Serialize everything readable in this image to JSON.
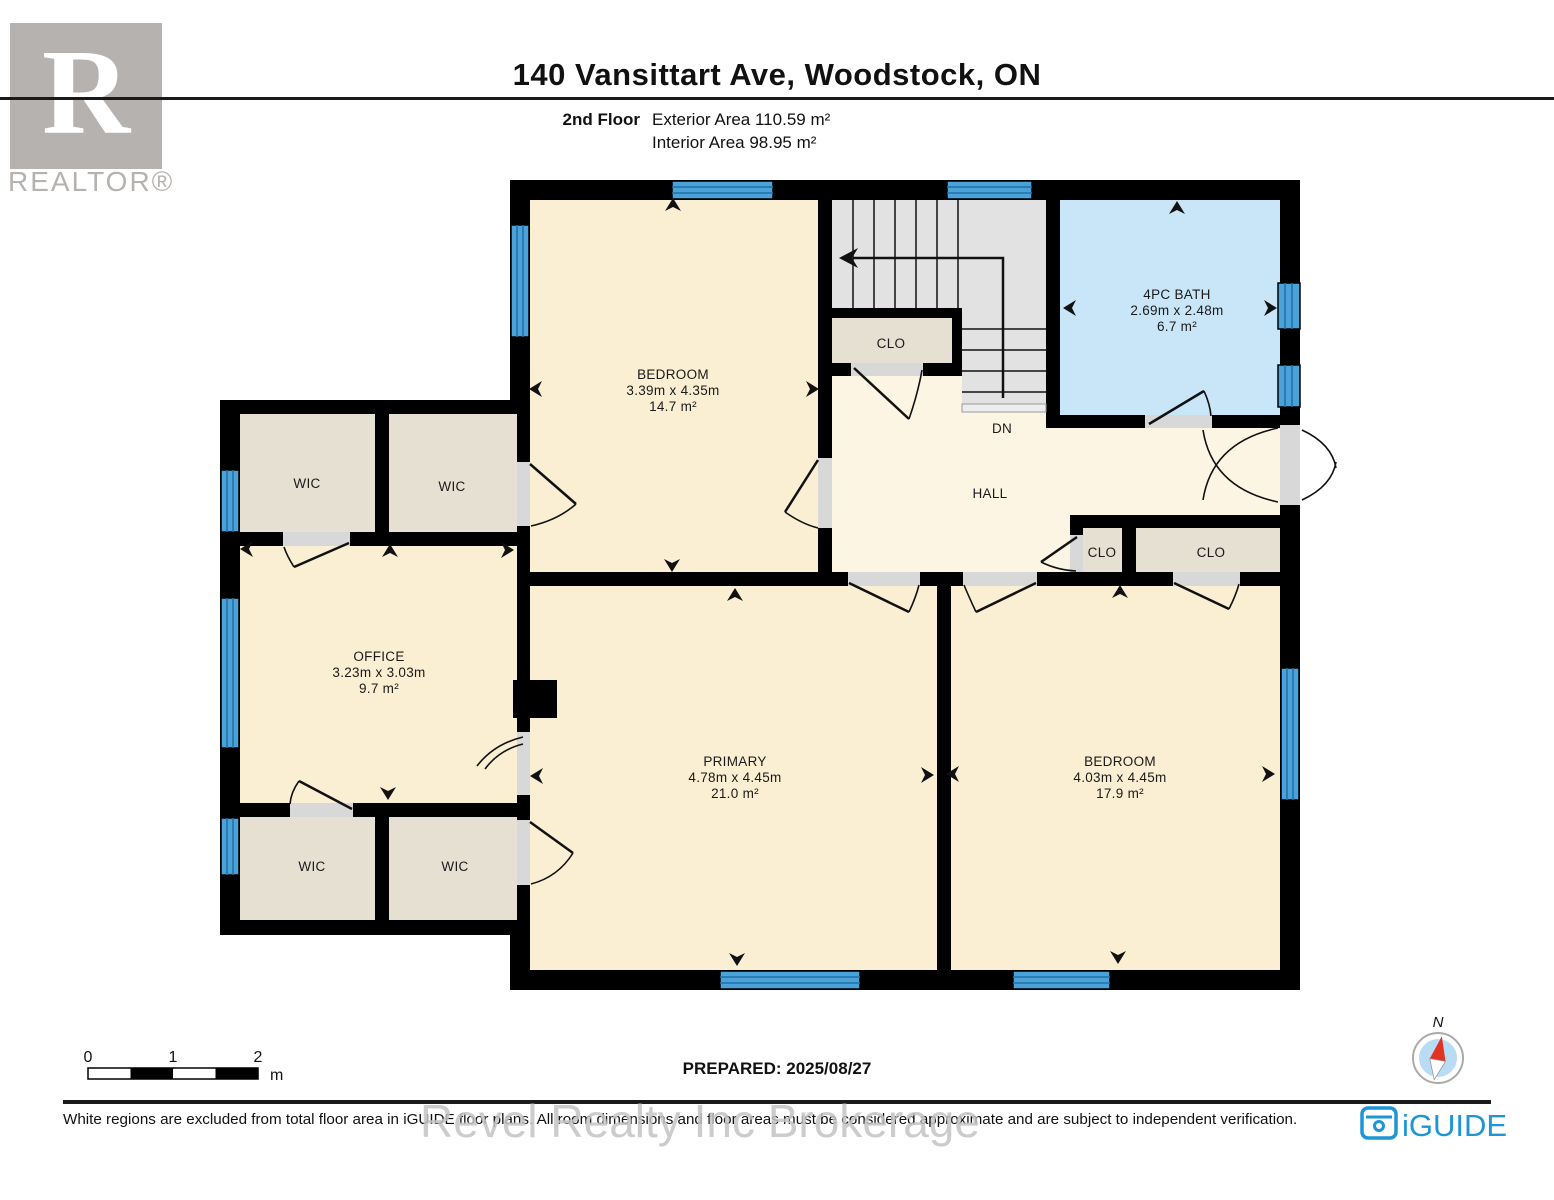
{
  "header": {
    "title": "140 Vansittart Ave, Woodstock, ON",
    "floor_label": "2nd Floor",
    "exterior_area": "Exterior Area 110.59 m²",
    "interior_area": "Interior Area 98.95 m²"
  },
  "branding": {
    "realtor_logo_letter": "R",
    "realtor_text": "REALTOR®",
    "iguide_text": "iGUIDE",
    "watermark": "Revel Realty Inc Brokerage"
  },
  "rooms": {
    "bedroom_top": {
      "name": "BEDROOM",
      "dims": "3.39m x 4.35m",
      "area": "14.7 m²"
    },
    "bath": {
      "name": "4PC BATH",
      "dims": "2.69m x 2.48m",
      "area": "6.7 m²"
    },
    "office": {
      "name": "OFFICE",
      "dims": "3.23m x 3.03m",
      "area": "9.7 m²"
    },
    "primary": {
      "name": "PRIMARY",
      "dims": "4.78m x 4.45m",
      "area": "21.0 m²"
    },
    "bedroom_right": {
      "name": "BEDROOM",
      "dims": "4.03m x 4.45m",
      "area": "17.9 m²"
    },
    "hall_label": "HALL",
    "down_label": "DN",
    "closet_upper": "CLO",
    "closet_small": "CLO",
    "closet_wide": "CLO",
    "wic_upper_left": "WIC",
    "wic_upper_right": "WIC",
    "wic_lower_left": "WIC",
    "wic_lower_right": "WIC"
  },
  "scale_bar": {
    "tick_0": "0",
    "tick_1": "1",
    "tick_2": "2",
    "unit": "m"
  },
  "prepared_label": "PREPARED: 2025/08/27",
  "compass_label": "N",
  "footer_disclaimer": "White regions are excluded from total floor area in iGUIDE floor plans. All room dimensions and floor areas must be considered approximate and are subject to independent verification.",
  "colors": {
    "room_fill": "#FAEFD2",
    "hall_fill": "#FCF5E3",
    "bath_fill": "#C9E6F8",
    "closet_fill": "#E6E0D3",
    "stairs_fill": "#E2E2E2",
    "window_fill": "#4BA2D9",
    "wall": "#000000",
    "iguide_blue": "#1E95D4",
    "compass_red": "#E23222"
  }
}
